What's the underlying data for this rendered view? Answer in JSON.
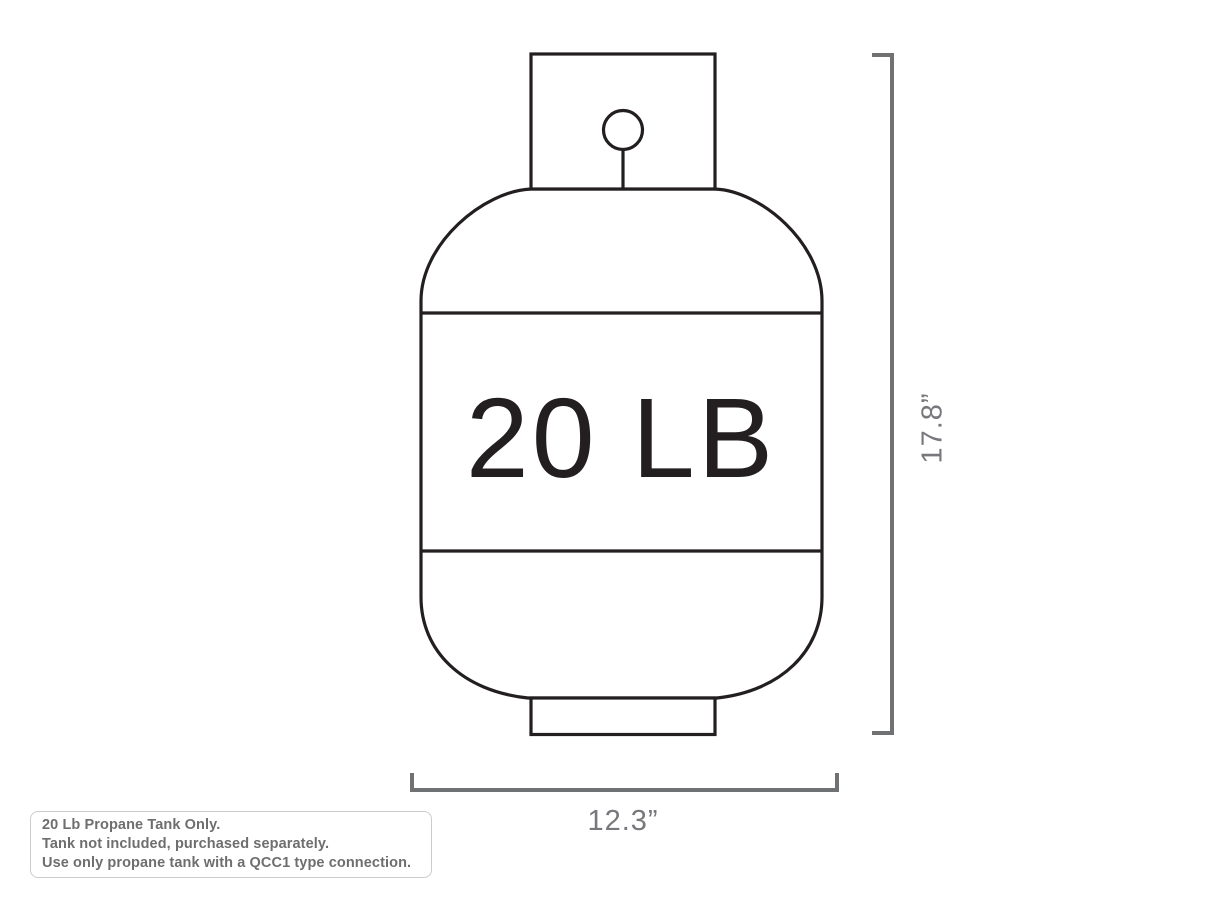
{
  "diagram_title": "20 lb propane tank dimension diagram",
  "tank": {
    "capacity_label": "20 LB"
  },
  "dimensions": {
    "height_label": "17.8”",
    "width_label": "12.3”"
  },
  "notes": {
    "lines": [
      "20 Lb Propane Tank Only.",
      "Tank not included, purchased separately.",
      "Use only propane tank with a QCC1 type connection."
    ]
  },
  "colors": {
    "outline": "#231f20",
    "dimension_gray": "#6f7173",
    "dimension_text_gray": "#77787b",
    "note_text_gray": "#6e6e6e",
    "note_border_gray": "#cccccc",
    "background": "#ffffff"
  }
}
